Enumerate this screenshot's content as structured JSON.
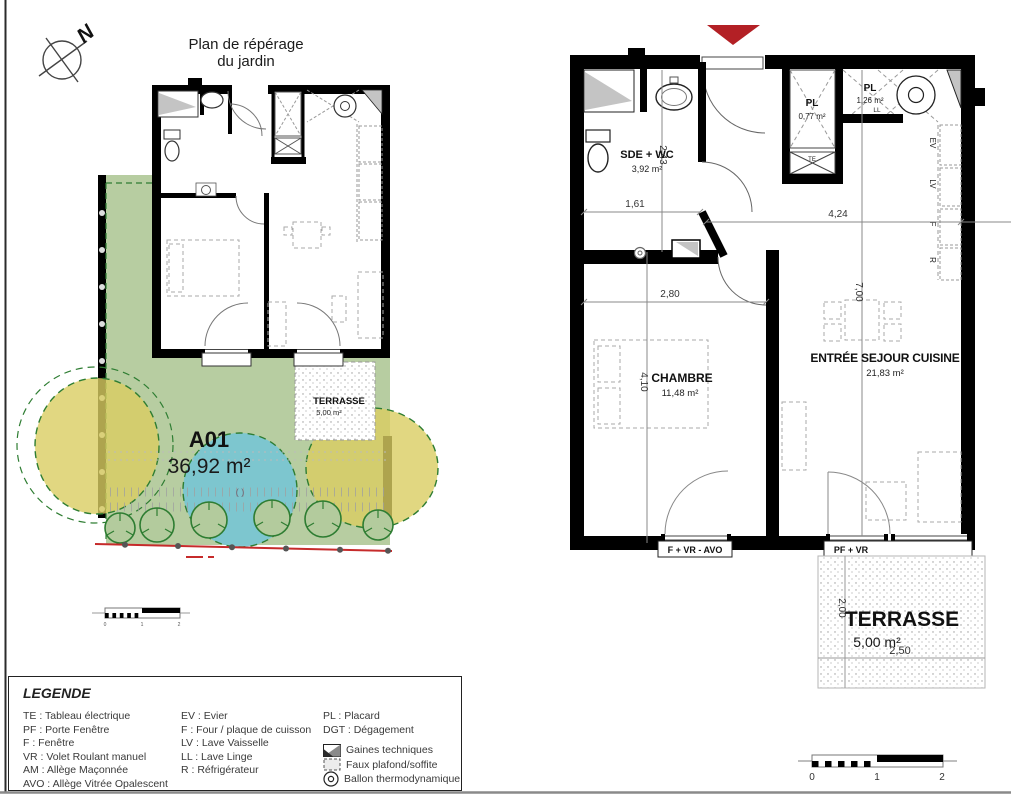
{
  "page": {
    "title1": "Plan de répérage",
    "title2": "du jardin",
    "north": "N"
  },
  "site_plan": {
    "unit": "A01",
    "unit_area": "36,92 m²",
    "terrace_name": "TERRASSE",
    "terrace_area": "5,00 m²",
    "center_mark": "( )"
  },
  "floor_plan": {
    "rooms": {
      "sde": {
        "name": "SDE + WC",
        "area": "3,92 m²"
      },
      "pl_small": {
        "name": "PL",
        "area": "0,77 m²"
      },
      "pl_large": {
        "name": "PL",
        "area": "1,26 m²"
      },
      "chambre": {
        "name": "CHAMBRE",
        "area": "11,48 m²"
      },
      "sejour": {
        "name": "ENTRÉE SEJOUR CUISINE",
        "area": "21,83 m²"
      },
      "terrasse": {
        "name": "TERRASSE",
        "area": "5,00 m²"
      }
    },
    "dims": {
      "sde_width": "1,61",
      "sde_depth": "2,43",
      "chambre_width": "2,80",
      "chambre_depth": "4,10",
      "sejour_width": "4,24",
      "sejour_depth": "7,00",
      "terrasse_depth": "2,00",
      "terrasse_width": "2,50"
    },
    "tags": {
      "te": "TE",
      "ll": "LL",
      "ev": "EV",
      "lv": "LV",
      "f": "F",
      "r": "R"
    },
    "windows": {
      "chambre": "F + VR - AVO",
      "sejour": "PF + VR"
    }
  },
  "legend": {
    "title": "LEGENDE",
    "col1": [
      "TE :  Tableau électrique",
      "PF :  Porte Fenêtre",
      "F :   Fenêtre",
      "VR :  Volet Roulant manuel",
      "AM :  Allège Maçonnée",
      "AVO :  Allège Vitrée Opalescent"
    ],
    "col2": [
      "EV :  Evier",
      "F :  Four / plaque de cuisson",
      "LV :  Lave Vaisselle",
      "LL :  Lave Linge",
      "R :  Réfrigérateur"
    ],
    "col3": [
      "PL :  Placard",
      "DGT : Dégagement"
    ],
    "symbols": [
      {
        "icon": "gaines-techniques-swatch",
        "label": "Gaines techniques"
      },
      {
        "icon": "faux-plafond-swatch",
        "label": "Faux plafond/soffite"
      },
      {
        "icon": "ballon-thermodynamique-symbol",
        "label": "Ballon thermodynamique"
      }
    ]
  },
  "scale_bar": {
    "t0": "0",
    "t1": "1",
    "t2": "2"
  },
  "colors": {
    "garden_green": "#b7cda1",
    "shrub_yellow": "#d9cd61",
    "lawn_blue": "#77c6d2",
    "tree_green": "#2e7d32",
    "boundary_red": "#c62b2b",
    "arrow_red": "#b32025",
    "gaines_gray": "#c4c4c4",
    "wall_black": "#000000"
  }
}
